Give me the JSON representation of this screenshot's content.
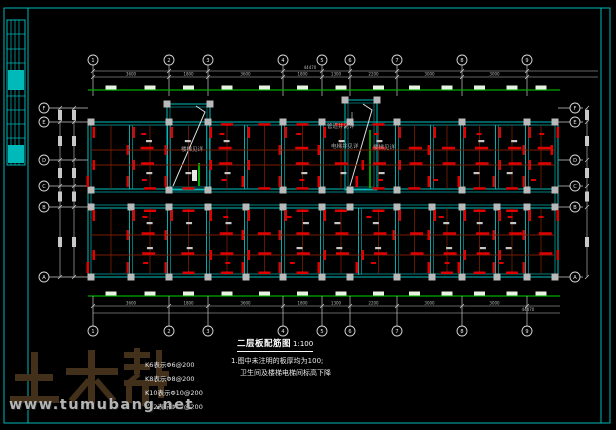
{
  "colors": {
    "frame": "#00b9b9",
    "wall": "#00c0c0",
    "wall_inner": "#008383",
    "beam_dark": "#7c1d00",
    "rebar_red": "#e00000",
    "column_gray": "#b9b9b9",
    "axis_green": "#00ad00",
    "dash_white": "#e8f2e0",
    "line_gray": "#c8c8c8",
    "text_gray": "#b9b9b9",
    "label_gray": "#a8a8a8",
    "stair_green": "#00dd00",
    "logo_brown": "#42301a"
  },
  "watermark": {
    "logo": "土木帮",
    "url": "www.tumubang.net"
  },
  "drawing_title": {
    "name": "二层板配筋图",
    "scale": "1:100"
  },
  "notes": [
    "1.图中未注明的板厚均为100;",
    "卫生间及楼梯电梯间标高下降"
  ],
  "slab_legend": [
    "K6表示Φ6@200",
    "K8表示Φ8@200",
    "K10表示Φ10@200",
    "K12表示Φ12@200"
  ],
  "plan_labels": {
    "stair_left": "楼梯见详",
    "pipe_shaft": "管道井见详",
    "elevator_shaft": "电梯井见详",
    "stair_right": "楼梯见详"
  },
  "axes": {
    "top": [
      "1",
      "2",
      "3",
      "4",
      "5",
      "6",
      "7",
      "8",
      "9"
    ],
    "bottom": [
      "1",
      "2",
      "3",
      "4",
      "5",
      "6",
      "7",
      "8",
      "9"
    ],
    "left": [
      "F",
      "E",
      "D",
      "C",
      "B",
      "A"
    ],
    "right": [
      "F",
      "E",
      "D",
      "C",
      "B",
      "A"
    ],
    "x_positions": [
      93,
      169,
      208,
      283,
      322,
      350,
      397,
      462,
      527
    ],
    "y_positions": [
      108,
      122,
      160,
      186,
      207,
      277
    ],
    "top_segments": [
      "3600",
      "1800",
      "3600",
      "1800",
      "1300",
      "2200",
      "3000",
      "3000"
    ],
    "bottom_segments": [
      "3600",
      "1800",
      "3600",
      "1800",
      "1300",
      "2200",
      "3000",
      "3000"
    ],
    "overall": "44470"
  }
}
